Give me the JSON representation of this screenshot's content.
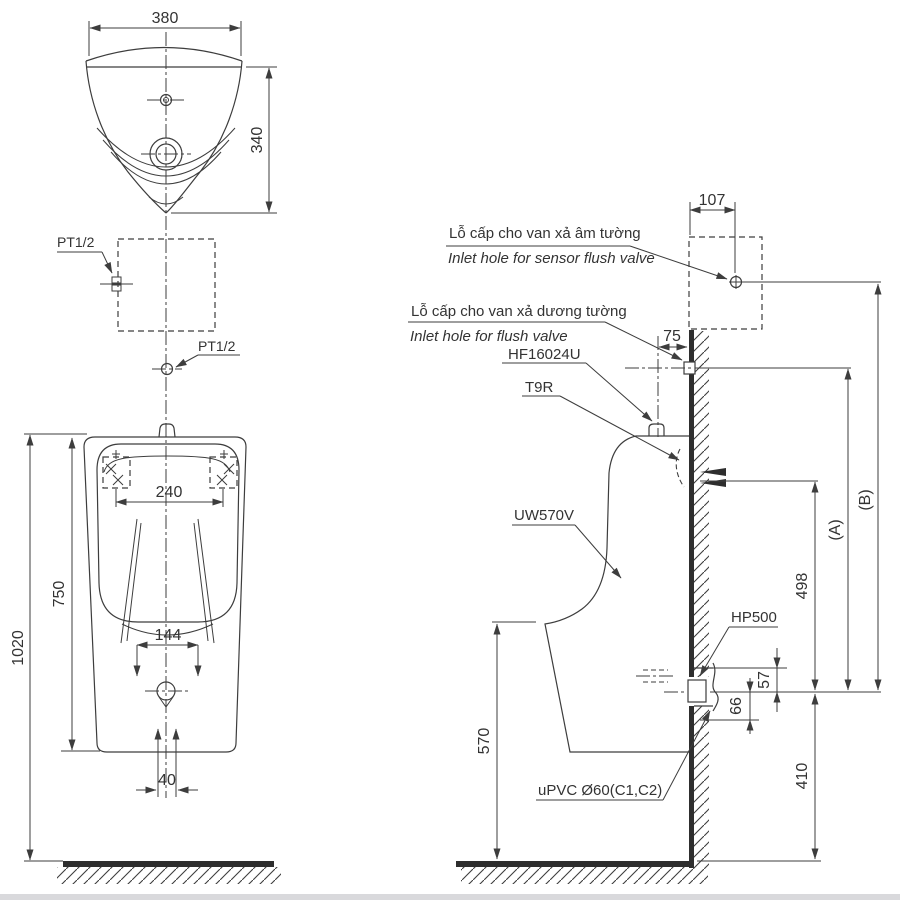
{
  "drawing": {
    "product_code": "UW570V",
    "colors": {
      "line": "#3d3d3d",
      "text": "#333333"
    }
  },
  "labels": {
    "dim_380": "380",
    "dim_340": "340",
    "pt12_top": "PT1/2",
    "pt12_bottom": "PT1/2",
    "dim_240": "240",
    "dim_750": "750",
    "dim_144": "144",
    "dim_1020": "1020",
    "dim_40": "40",
    "note_sensor_vi": "Lỗ cấp cho van xả âm tường",
    "note_sensor_en": "Inlet hole for sensor flush valve",
    "note_flush_vi": "Lỗ cấp cho van xả dương tường",
    "note_flush_en": "Inlet hole for flush valve",
    "part_spud": "HF16024U",
    "part_t9r": "T9R",
    "part_body": "UW570V",
    "part_hp500": "HP500",
    "part_upvc": "uPVC Ø60(C1,C2)",
    "dim_107": "107",
    "dim_75": "75",
    "dim_498": "498",
    "dim_a": "(A)",
    "dim_b": "(B)",
    "dim_57": "57",
    "dim_66": "66",
    "dim_570": "570",
    "dim_410": "410"
  }
}
